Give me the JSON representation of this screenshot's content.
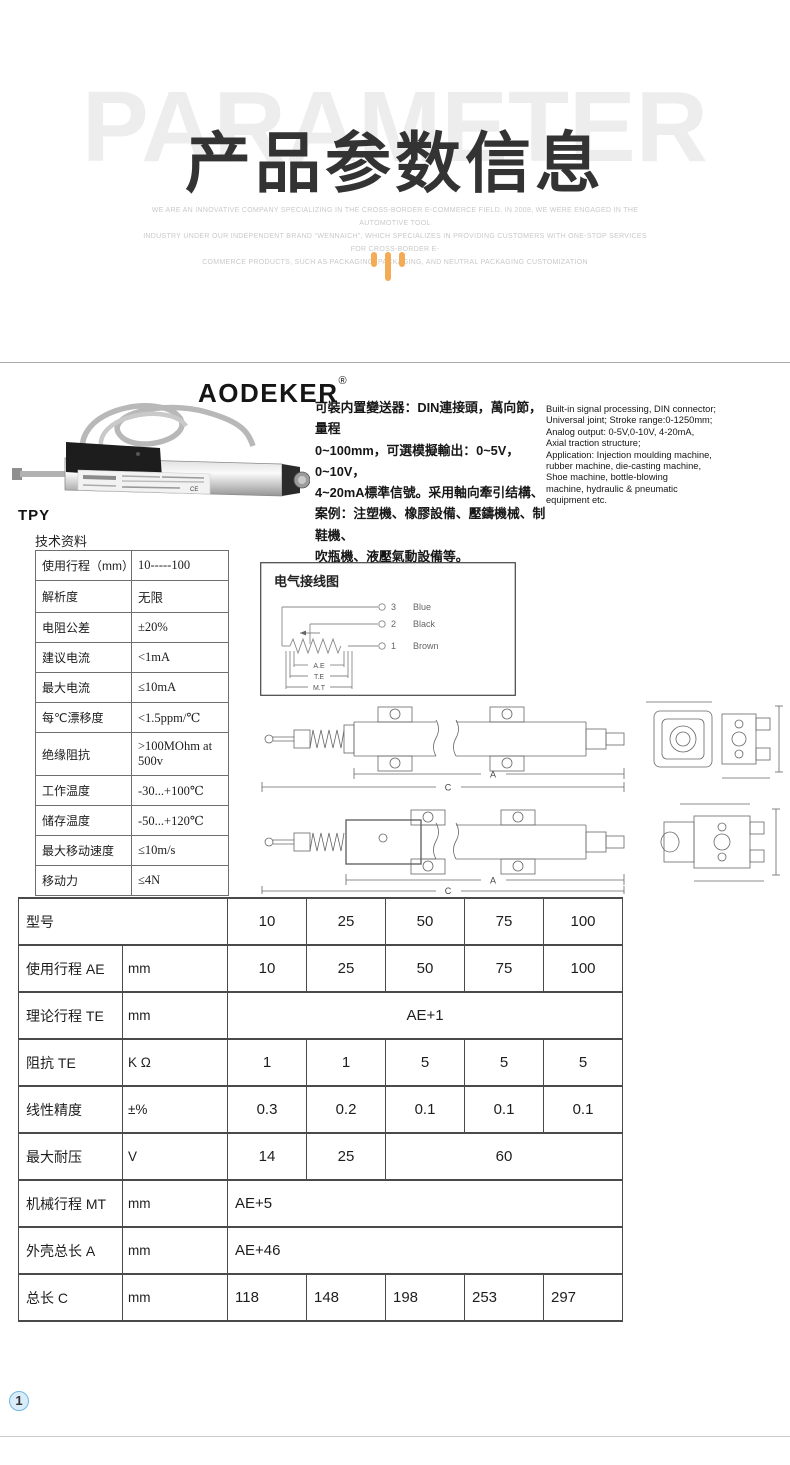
{
  "colors": {
    "accent_orange": "#F3AC55",
    "title_dark": "#333333",
    "watermark_gray": "#EDEDED",
    "badge_blue": "#72B8E0"
  },
  "header": {
    "watermark": "PARAMETER",
    "title": "产品参数信息",
    "subtitle_lines": [
      "WE ARE AN INNOVATIVE COMPANY SPECIALIZING IN THE CROSS-BORDER E-COMMERCE FIELD. IN 2008, WE WERE ENGAGED IN THE AUTOMOTIVE TOOL",
      "INDUSTRY UNDER OUR INDEPENDENT BRAND \"WENNAICH\", WHICH SPECIALIZES IN PROVIDING CUSTOMERS WITH ONE-STOP SERVICES FOR CROSS-BORDER E-",
      "COMMERCE PRODUCTS, SUCH AS PACKAGING, PACKAGING, AND NEUTRAL PACKAGING CUSTOMIZATION"
    ]
  },
  "product": {
    "brand": "AODEKER",
    "reg_mark": "®",
    "label_mark": "CE",
    "description_zh_lines": [
      "可裝内置變送器：DIN連接頭，萬向節，量程",
      "0~100mm，可選模擬輸出：0~5V，0~10V，",
      "4~20mA標準信號。采用軸向牽引结構、",
      "案例：注塑機、橡膠設備、壓鑄機械、制鞋機、",
      "吹瓶機、液壓氣動設備等。"
    ],
    "description_en_lines": [
      "Built-in signal processing, DIN connector;",
      "Universal joint; Stroke range:0-1250mm;",
      "Analog output: 0-5V,0-10V, 4-20mA,",
      "Axial traction structure;",
      "Application: Injection moulding machine,",
      "rubber machine, die-casting machine,",
      "Shoe machine, bottle-blowing",
      "machine, hydraulic & pneumatic",
      "equipment etc."
    ]
  },
  "model_label": "TPY",
  "spec_table": {
    "title": "技术资料",
    "rows": [
      {
        "label": "使用行程（mm）",
        "value": "10-----100"
      },
      {
        "label": "解析度",
        "value": "无限"
      },
      {
        "label": "电阻公差",
        "value": "±20%"
      },
      {
        "label": "建议电流",
        "value": "<1mA"
      },
      {
        "label": "最大电流",
        "value": "≤10mA"
      },
      {
        "label": "每℃漂移度",
        "value": "<1.5ppm/℃"
      },
      {
        "label": "绝缘阻抗",
        "value": ">100MOhm at 500v"
      },
      {
        "label": "工作温度",
        "value": "-30...+100℃"
      },
      {
        "label": "储存温度",
        "value": "-50...+120℃"
      },
      {
        "label": "最大移动速度",
        "value": "≤10m/s"
      },
      {
        "label": "移动力",
        "value": "≤4N"
      }
    ]
  },
  "wiring": {
    "title": "电气接线图",
    "terminals": [
      {
        "num": "3",
        "label": "Blue"
      },
      {
        "num": "2",
        "label": "Black"
      },
      {
        "num": "1",
        "label": "Brown"
      }
    ],
    "dims": [
      "A.E",
      "T.E",
      "M.T"
    ]
  },
  "drawings": {
    "dim_a_label": "A",
    "dim_c_label": "C"
  },
  "param_table": {
    "rows": [
      {
        "label": "型号",
        "unit": "",
        "values": [
          "10",
          "25",
          "50",
          "75",
          "100"
        ]
      },
      {
        "label": "使用行程 AE",
        "unit": "mm",
        "values": [
          "10",
          "25",
          "50",
          "75",
          "100"
        ]
      },
      {
        "label": "理论行程 TE",
        "unit": "mm",
        "span_value": "AE+1"
      },
      {
        "label": "阻抗 TE",
        "unit": "K Ω",
        "values": [
          "1",
          "1",
          "5",
          "5",
          "5"
        ]
      },
      {
        "label": "线性精度",
        "unit": "±%",
        "values": [
          "0.3",
          "0.2",
          "0.1",
          "0.1",
          "0.1"
        ]
      },
      {
        "label": "最大耐压",
        "unit": "V",
        "values": [
          "14",
          "25"
        ],
        "span_value": "60"
      },
      {
        "label": "机械行程 MT",
        "unit": "mm",
        "span_value": "AE+5"
      },
      {
        "label": "外壳总长 A",
        "unit": "mm",
        "span_value": "AE+46"
      },
      {
        "label": "总长 C",
        "unit": "mm",
        "values": [
          "118",
          "148",
          "198",
          "253",
          "297"
        ]
      }
    ]
  },
  "footer": {
    "page_badge": "1"
  }
}
